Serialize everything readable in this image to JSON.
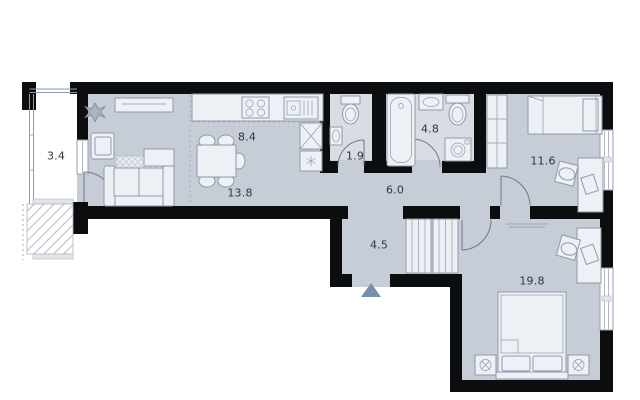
{
  "plan": {
    "type": "apartment-floor-plan",
    "rooms": [
      {
        "id": "balcony",
        "area_label": "3.4"
      },
      {
        "id": "kitchen",
        "area_label": "8.4"
      },
      {
        "id": "living-room",
        "area_label": "13.8"
      },
      {
        "id": "wc",
        "area_label": "1.9"
      },
      {
        "id": "bathroom",
        "area_label": "4.8"
      },
      {
        "id": "hallway",
        "area_label": "6.0"
      },
      {
        "id": "bedroom-1",
        "area_label": "11.6"
      },
      {
        "id": "entrance-hall",
        "area_label": "4.5"
      },
      {
        "id": "bedroom-2",
        "area_label": "19.8"
      }
    ],
    "entrance": {
      "marker": "triangle-up"
    },
    "icons": [
      "plant-icon",
      "tv-stand-icon",
      "armchair-icon",
      "sofa-icon",
      "rug-icon",
      "coffee-table-icon",
      "dining-table-icon",
      "dining-chair-icon",
      "kitchen-counter-icon",
      "stove-icon",
      "kitchen-sink-icon",
      "tall-cabinet-icon",
      "fridge-icon",
      "toilet-icon",
      "washbasin-icon",
      "bathtub-icon",
      "washing-machine-icon",
      "wardrobe-icon",
      "closet-icon",
      "single-bed-icon",
      "double-bed-icon",
      "nightstand-icon",
      "desk-icon",
      "desk-chair-icon",
      "radiator-icon",
      "window-icon",
      "door-swing-icon",
      "entrance-arrow-icon",
      "balcony-hatch-icon"
    ],
    "colors": {
      "wall": "#0c0d0f",
      "floor": "#c6cdd7",
      "wet_floor": "#d8dce3",
      "balcony_floor": "#ffffff",
      "furniture": "#edf0f4",
      "outline": "#8f9aa7",
      "entrance_marker": "#7590ab",
      "label": "#30363f",
      "hatch": "#b9c0c8"
    }
  }
}
